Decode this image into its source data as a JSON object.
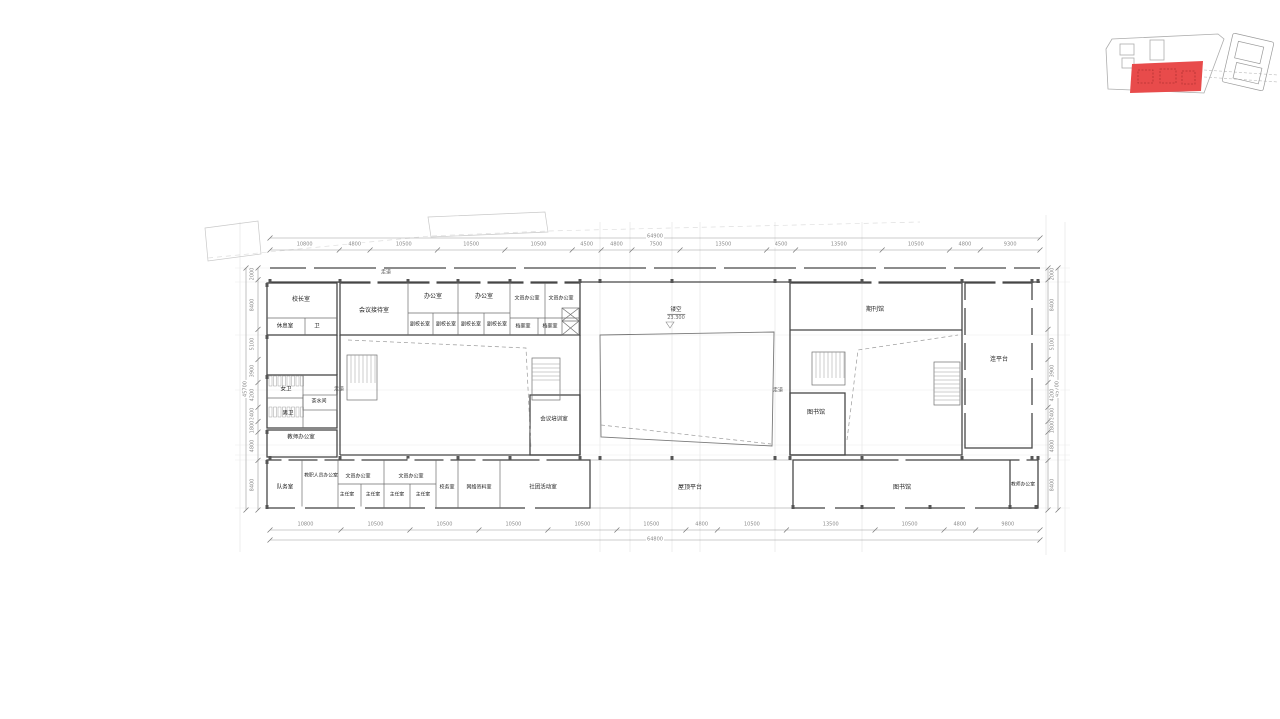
{
  "floor_plan": {
    "corridor_labels": {
      "top": "走道",
      "left": "走道",
      "right": "走道"
    },
    "void_marker": {
      "label": "镂空",
      "level": "23.300"
    },
    "rooms": [
      "校长室",
      "休息室",
      "卫",
      "会议接待室",
      "办公室",
      "办公室",
      "副校长室",
      "副校长室",
      "副校长室",
      "副校长室",
      "文员办公室",
      "文员办公室",
      "档案室",
      "档案室",
      "女卫",
      "茶水间",
      "男卫",
      "教师办公室",
      "会议培训室",
      "期刊馆",
      "图书馆",
      "连平台",
      "队务室",
      "教职人员办公室",
      "文员办公室",
      "文员办公室",
      "主任室",
      "主任室",
      "主任室",
      "主任室",
      "校务室",
      "网络资料室",
      "社团活动室",
      "屋顶平台",
      "图书馆",
      "教师办公室"
    ],
    "dimensions": {
      "top": {
        "total": "64900",
        "segments": [
          "10800",
          "4800",
          "10500",
          "10500",
          "10500",
          "4500",
          "4800",
          "7500",
          "13500",
          "4500",
          "13500",
          "10500",
          "4800",
          "9300"
        ]
      },
      "bottom": {
        "total": "64800",
        "segments": [
          "10800",
          "10500",
          "10500",
          "10500",
          "10500",
          "10500",
          "4800",
          "10500",
          "13500",
          "10500",
          "4800",
          "9800"
        ]
      },
      "left": {
        "total": "45700",
        "segments": [
          "2000",
          "8400",
          "5100",
          "3900",
          "4200",
          "2400",
          "1800",
          "4800",
          "8400"
        ]
      },
      "right": {
        "total": "45700",
        "segments": [
          "2000",
          "8400",
          "5100",
          "3900",
          "4200",
          "2400",
          "1800",
          "4800",
          "8400"
        ]
      }
    },
    "key_plan": {
      "highlight_color": "#e84b4b"
    }
  }
}
